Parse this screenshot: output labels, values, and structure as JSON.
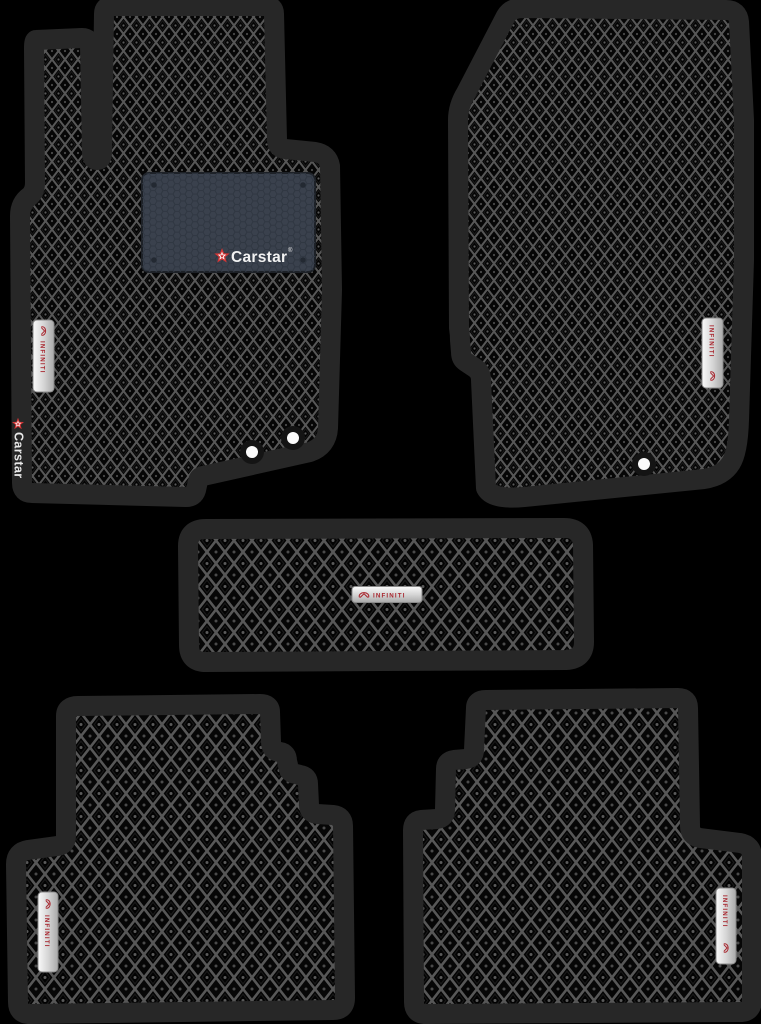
{
  "scene": {
    "type": "product-photo",
    "subject": "Set of 5 EVA car floor mats with rhombus cell pattern, black mats with black trim",
    "background_color": "#000000"
  },
  "colors": {
    "trim": "#272727",
    "cell_black": "#050505",
    "lattice_gray": "#575757",
    "heel_pad": "#3a414d",
    "brand_red": "#a8262e",
    "star_red": "#d23535",
    "label_silver": "#ececec",
    "eyelet_white": "#fbfbfb"
  },
  "branding": {
    "carstar": {
      "name": "Carstar",
      "reg": "®"
    },
    "infiniti": {
      "name": "INFINITI"
    }
  },
  "mats": [
    {
      "position": "front-driver",
      "badges": [
        "Carstar heel-pad logo",
        "INFINITI side badge",
        "Carstar vertical edge logo"
      ],
      "eyelets": 2
    },
    {
      "position": "front-passenger",
      "badges": [
        "INFINITI side badge"
      ],
      "eyelets": 1
    },
    {
      "position": "tunnel",
      "badges": [
        "INFINITI center badge"
      ],
      "eyelets": 0
    },
    {
      "position": "rear-left",
      "badges": [
        "INFINITI side badge"
      ],
      "eyelets": 0
    },
    {
      "position": "rear-right",
      "badges": [
        "INFINITI side badge"
      ],
      "eyelets": 0
    }
  ]
}
